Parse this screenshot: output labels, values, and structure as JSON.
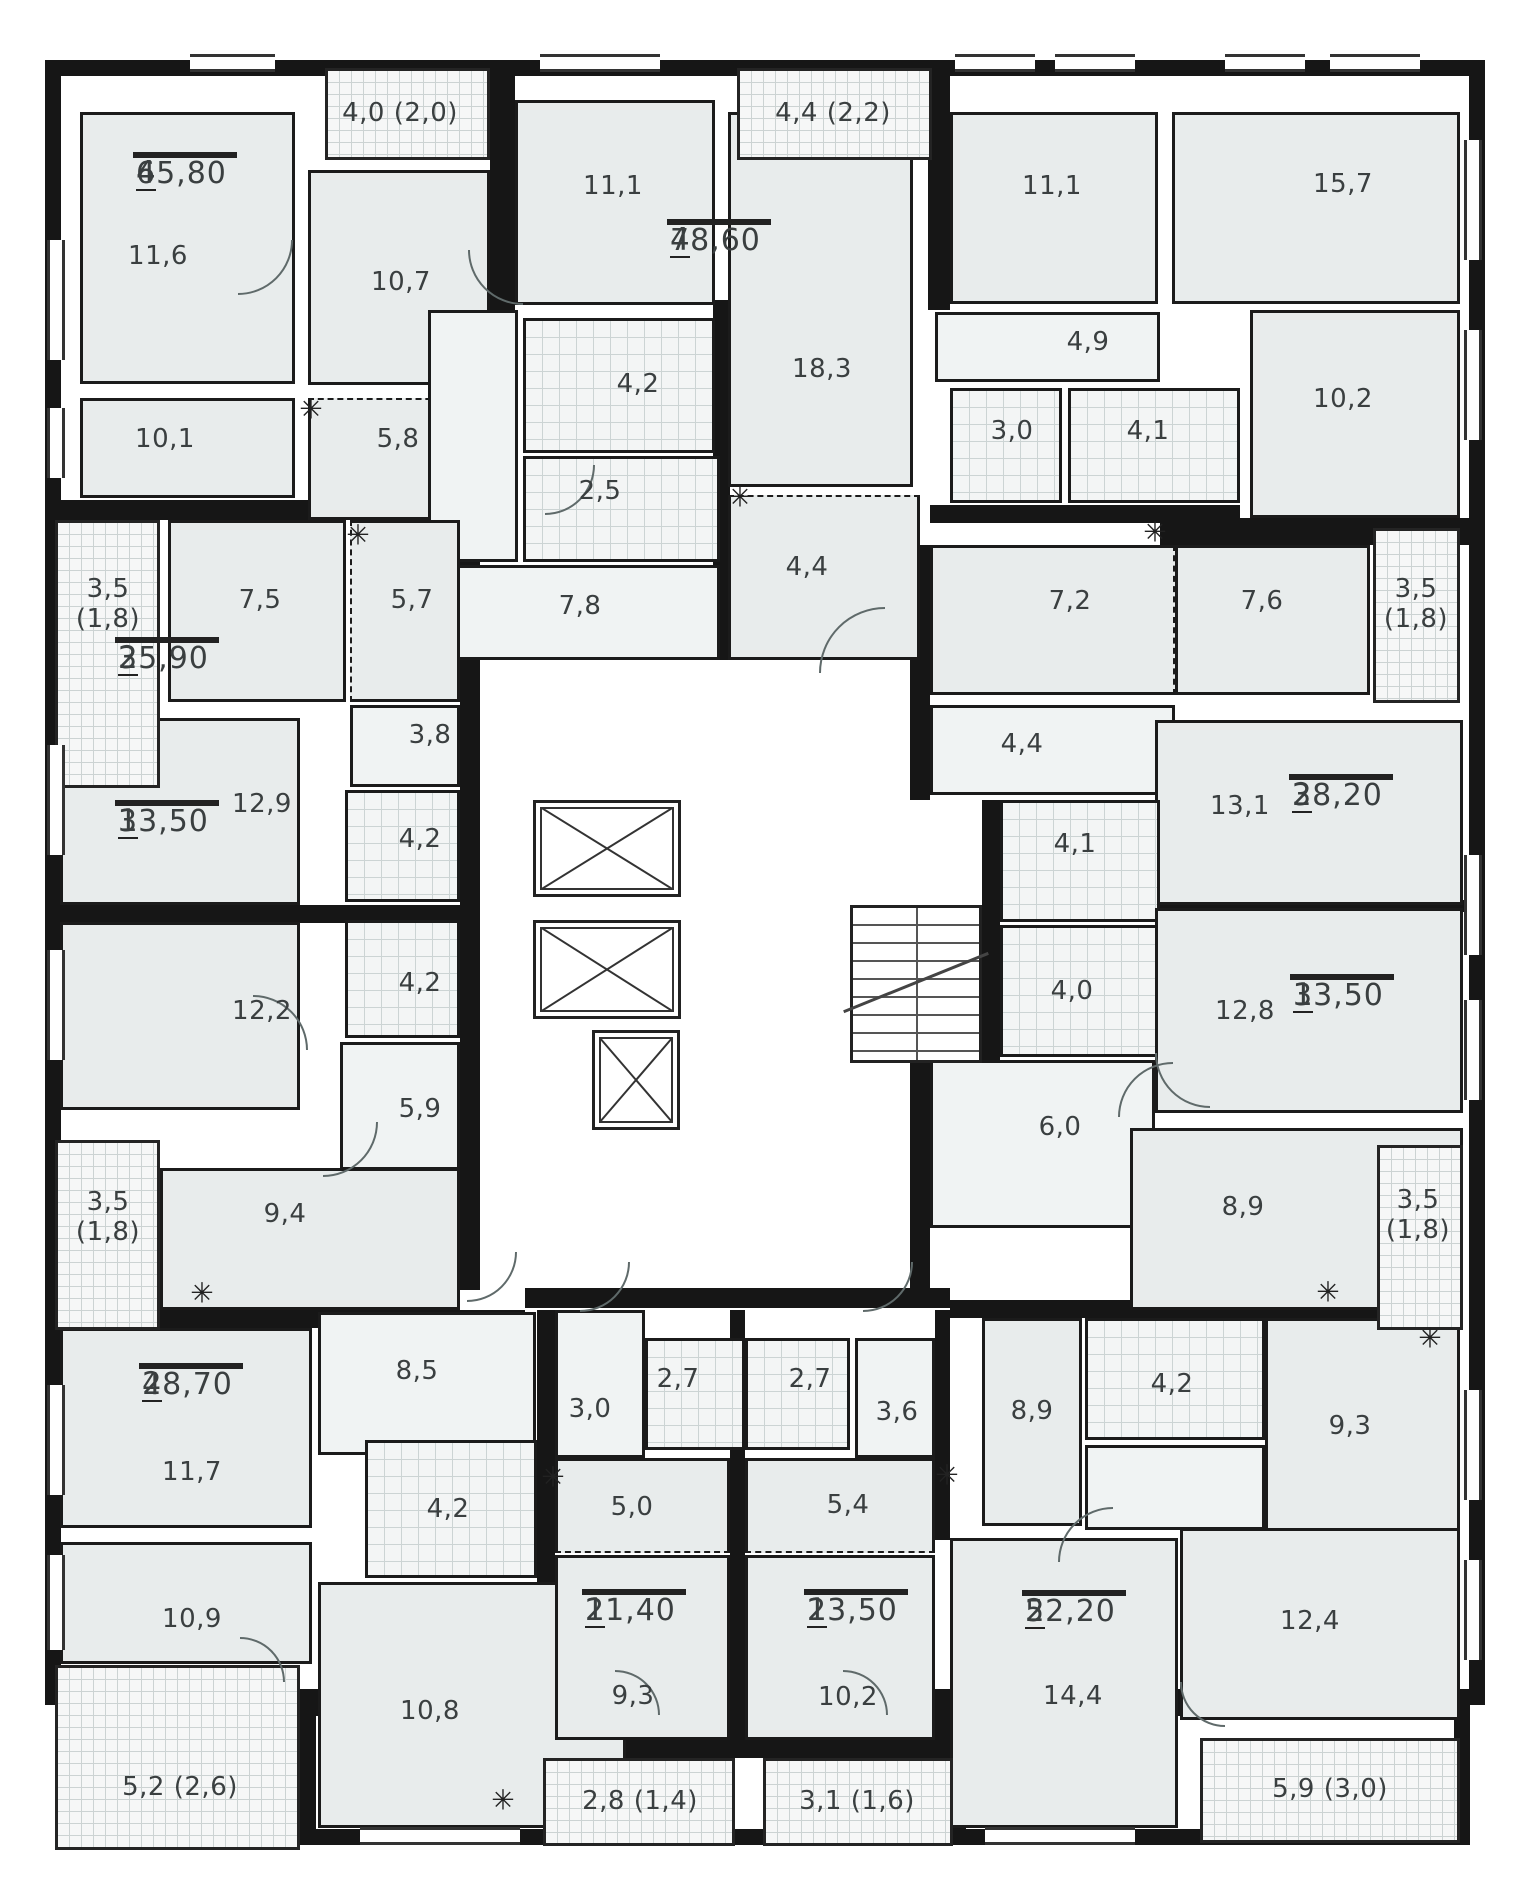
{
  "plan": {
    "canvas": {
      "w": 1529,
      "h": 1900
    },
    "colors": {
      "wall": "#161616",
      "room": "#e8ecec",
      "hall": "#f0f3f3",
      "wet_tile": "#f3f5f5",
      "balcony": "#f6f7f7",
      "text": "#3a3f40"
    },
    "envelope": [
      {
        "x": 45,
        "y": 60,
        "w": 1440,
        "h": 1645
      },
      {
        "x": 300,
        "y": 1700,
        "w": 650,
        "h": 145
      },
      {
        "x": 950,
        "y": 1700,
        "w": 520,
        "h": 145
      }
    ],
    "walls": [
      {
        "x": 490,
        "y": 60,
        "w": 25,
        "h": 460
      },
      {
        "x": 45,
        "y": 500,
        "w": 420,
        "h": 20
      },
      {
        "x": 460,
        "y": 520,
        "w": 20,
        "h": 770
      },
      {
        "x": 713,
        "y": 300,
        "w": 17,
        "h": 360
      },
      {
        "x": 928,
        "y": 60,
        "w": 22,
        "h": 250
      },
      {
        "x": 930,
        "y": 505,
        "w": 310,
        "h": 18
      },
      {
        "x": 1160,
        "y": 518,
        "w": 325,
        "h": 27
      },
      {
        "x": 910,
        "y": 545,
        "w": 20,
        "h": 255
      },
      {
        "x": 982,
        "y": 800,
        "w": 18,
        "h": 260
      },
      {
        "x": 910,
        "y": 1060,
        "w": 20,
        "h": 230
      },
      {
        "x": 1155,
        "y": 900,
        "w": 330,
        "h": 12
      },
      {
        "x": 45,
        "y": 905,
        "w": 420,
        "h": 18
      },
      {
        "x": 45,
        "y": 1310,
        "w": 480,
        "h": 18
      },
      {
        "x": 525,
        "y": 1288,
        "w": 425,
        "h": 20
      },
      {
        "x": 730,
        "y": 1310,
        "w": 15,
        "h": 430
      },
      {
        "x": 537,
        "y": 1310,
        "w": 18,
        "h": 430
      },
      {
        "x": 935,
        "y": 1310,
        "w": 15,
        "h": 230
      },
      {
        "x": 950,
        "y": 1300,
        "w": 513,
        "h": 18
      },
      {
        "x": 543,
        "y": 1740,
        "w": 392,
        "h": 18
      }
    ],
    "rooms": [
      {
        "x": 80,
        "y": 112,
        "w": 215,
        "h": 272,
        "f": "rm"
      },
      {
        "x": 80,
        "y": 398,
        "w": 215,
        "h": 100,
        "f": "rm"
      },
      {
        "x": 308,
        "y": 170,
        "w": 182,
        "h": 215,
        "f": "rm"
      },
      {
        "x": 308,
        "y": 398,
        "w": 182,
        "h": 122,
        "f": "rm",
        "d": "t"
      },
      {
        "x": 515,
        "y": 100,
        "w": 200,
        "h": 205,
        "f": "rm"
      },
      {
        "x": 523,
        "y": 318,
        "w": 192,
        "h": 135,
        "f": "wet"
      },
      {
        "x": 523,
        "y": 456,
        "w": 197,
        "h": 106,
        "f": "wet"
      },
      {
        "x": 428,
        "y": 310,
        "w": 90,
        "h": 252,
        "f": "hall"
      },
      {
        "x": 428,
        "y": 565,
        "w": 292,
        "h": 95,
        "f": "hall"
      },
      {
        "x": 728,
        "y": 112,
        "w": 185,
        "h": 375,
        "f": "rm"
      },
      {
        "x": 728,
        "y": 495,
        "w": 192,
        "h": 165,
        "f": "rm",
        "d": "t"
      },
      {
        "x": 950,
        "y": 112,
        "w": 208,
        "h": 192,
        "f": "rm"
      },
      {
        "x": 1172,
        "y": 112,
        "w": 288,
        "h": 192,
        "f": "rm"
      },
      {
        "x": 935,
        "y": 312,
        "w": 225,
        "h": 70,
        "f": "hall"
      },
      {
        "x": 950,
        "y": 388,
        "w": 112,
        "h": 115,
        "f": "wet"
      },
      {
        "x": 1068,
        "y": 388,
        "w": 172,
        "h": 115,
        "f": "wet"
      },
      {
        "x": 1250,
        "y": 310,
        "w": 210,
        "h": 208,
        "f": "rm"
      },
      {
        "x": 930,
        "y": 545,
        "w": 245,
        "h": 150,
        "f": "rm",
        "d": "r"
      },
      {
        "x": 1175,
        "y": 545,
        "w": 195,
        "h": 150,
        "f": "rm"
      },
      {
        "x": 930,
        "y": 705,
        "w": 245,
        "h": 90,
        "f": "hall"
      },
      {
        "x": 1155,
        "y": 720,
        "w": 308,
        "h": 185,
        "f": "rm"
      },
      {
        "x": 1000,
        "y": 800,
        "w": 160,
        "h": 122,
        "f": "wet"
      },
      {
        "x": 1000,
        "y": 925,
        "w": 160,
        "h": 132,
        "f": "wet"
      },
      {
        "x": 1155,
        "y": 908,
        "w": 308,
        "h": 205,
        "f": "rm"
      },
      {
        "x": 930,
        "y": 1060,
        "w": 225,
        "h": 168,
        "f": "hall"
      },
      {
        "x": 1130,
        "y": 1128,
        "w": 333,
        "h": 182,
        "f": "rm"
      },
      {
        "x": 982,
        "y": 1318,
        "w": 100,
        "h": 208,
        "f": "rm"
      },
      {
        "x": 1085,
        "y": 1318,
        "w": 180,
        "h": 122,
        "f": "wet"
      },
      {
        "x": 1085,
        "y": 1445,
        "w": 180,
        "h": 85,
        "f": "hall"
      },
      {
        "x": 1265,
        "y": 1318,
        "w": 195,
        "h": 215,
        "f": "rm"
      },
      {
        "x": 950,
        "y": 1538,
        "w": 228,
        "h": 290,
        "f": "rm"
      },
      {
        "x": 1180,
        "y": 1528,
        "w": 280,
        "h": 192,
        "f": "rm"
      },
      {
        "x": 168,
        "y": 520,
        "w": 178,
        "h": 182,
        "f": "rm"
      },
      {
        "x": 350,
        "y": 520,
        "w": 110,
        "h": 182,
        "f": "rm",
        "d": "l"
      },
      {
        "x": 60,
        "y": 718,
        "w": 240,
        "h": 187,
        "f": "rm"
      },
      {
        "x": 350,
        "y": 705,
        "w": 110,
        "h": 82,
        "f": "hall"
      },
      {
        "x": 345,
        "y": 790,
        "w": 115,
        "h": 112,
        "f": "wet"
      },
      {
        "x": 60,
        "y": 922,
        "w": 240,
        "h": 188,
        "f": "rm"
      },
      {
        "x": 345,
        "y": 920,
        "w": 115,
        "h": 118,
        "f": "wet"
      },
      {
        "x": 340,
        "y": 1042,
        "w": 120,
        "h": 128,
        "f": "hall"
      },
      {
        "x": 160,
        "y": 1168,
        "w": 300,
        "h": 142,
        "f": "rm"
      },
      {
        "x": 60,
        "y": 1328,
        "w": 252,
        "h": 200,
        "f": "rm"
      },
      {
        "x": 60,
        "y": 1542,
        "w": 252,
        "h": 122,
        "f": "rm"
      },
      {
        "x": 318,
        "y": 1312,
        "w": 218,
        "h": 143,
        "f": "hall"
      },
      {
        "x": 365,
        "y": 1440,
        "w": 172,
        "h": 138,
        "f": "wet"
      },
      {
        "x": 318,
        "y": 1582,
        "w": 308,
        "h": 246,
        "f": "rm"
      },
      {
        "x": 555,
        "y": 1310,
        "w": 90,
        "h": 148,
        "f": "hall"
      },
      {
        "x": 645,
        "y": 1338,
        "w": 100,
        "h": 112,
        "f": "wet"
      },
      {
        "x": 555,
        "y": 1458,
        "w": 175,
        "h": 95,
        "f": "rm",
        "d": "b"
      },
      {
        "x": 555,
        "y": 1555,
        "w": 175,
        "h": 185,
        "f": "rm"
      },
      {
        "x": 745,
        "y": 1338,
        "w": 105,
        "h": 112,
        "f": "wet"
      },
      {
        "x": 855,
        "y": 1338,
        "w": 80,
        "h": 120,
        "f": "hall"
      },
      {
        "x": 745,
        "y": 1458,
        "w": 190,
        "h": 95,
        "f": "rm",
        "d": "b"
      },
      {
        "x": 745,
        "y": 1555,
        "w": 190,
        "h": 185,
        "f": "rm"
      }
    ],
    "room_labels": [
      {
        "text": "11,6",
        "x": 158,
        "y": 257
      },
      {
        "text": "10,1",
        "x": 165,
        "y": 440
      },
      {
        "text": "10,7",
        "x": 401,
        "y": 283
      },
      {
        "text": "5,8",
        "x": 398,
        "y": 440
      },
      {
        "text": "11,1",
        "x": 613,
        "y": 187
      },
      {
        "text": "4,2",
        "x": 638,
        "y": 385
      },
      {
        "text": "2,5",
        "x": 600,
        "y": 492
      },
      {
        "text": "7,8",
        "x": 580,
        "y": 607
      },
      {
        "text": "18,3",
        "x": 822,
        "y": 370
      },
      {
        "text": "4,4",
        "x": 807,
        "y": 568
      },
      {
        "text": "11,1",
        "x": 1052,
        "y": 187
      },
      {
        "text": "15,7",
        "x": 1343,
        "y": 185
      },
      {
        "text": "4,9",
        "x": 1088,
        "y": 343
      },
      {
        "text": "3,0",
        "x": 1012,
        "y": 432
      },
      {
        "text": "4,1",
        "x": 1148,
        "y": 432
      },
      {
        "text": "10,2",
        "x": 1343,
        "y": 400
      },
      {
        "text": "7,5",
        "x": 260,
        "y": 601
      },
      {
        "text": "5,7",
        "x": 412,
        "y": 601
      },
      {
        "text": "3,8",
        "x": 430,
        "y": 736
      },
      {
        "text": "12,9",
        "x": 262,
        "y": 805
      },
      {
        "text": "4,2",
        "x": 420,
        "y": 840
      },
      {
        "text": "7,2",
        "x": 1070,
        "y": 602
      },
      {
        "text": "7,6",
        "x": 1262,
        "y": 602
      },
      {
        "text": "4,4",
        "x": 1022,
        "y": 745
      },
      {
        "text": "13,1",
        "x": 1240,
        "y": 807
      },
      {
        "text": "4,1",
        "x": 1075,
        "y": 845
      },
      {
        "text": "4,0",
        "x": 1072,
        "y": 992
      },
      {
        "text": "12,8",
        "x": 1245,
        "y": 1012
      },
      {
        "text": "6,0",
        "x": 1060,
        "y": 1128
      },
      {
        "text": "12,2",
        "x": 262,
        "y": 1012
      },
      {
        "text": "4,2",
        "x": 420,
        "y": 984
      },
      {
        "text": "5,9",
        "x": 420,
        "y": 1110
      },
      {
        "text": "9,4",
        "x": 285,
        "y": 1215
      },
      {
        "text": "8,9",
        "x": 1243,
        "y": 1208
      },
      {
        "text": "11,7",
        "x": 192,
        "y": 1473
      },
      {
        "text": "8,5",
        "x": 417,
        "y": 1372
      },
      {
        "text": "4,2",
        "x": 448,
        "y": 1510
      },
      {
        "text": "10,9",
        "x": 192,
        "y": 1620
      },
      {
        "text": "10,8",
        "x": 430,
        "y": 1712
      },
      {
        "text": "3,0",
        "x": 590,
        "y": 1410
      },
      {
        "text": "2,7",
        "x": 678,
        "y": 1380
      },
      {
        "text": "2,7",
        "x": 810,
        "y": 1380
      },
      {
        "text": "3,6",
        "x": 897,
        "y": 1413
      },
      {
        "text": "5,0",
        "x": 632,
        "y": 1508
      },
      {
        "text": "5,4",
        "x": 848,
        "y": 1506
      },
      {
        "text": "9,3",
        "x": 633,
        "y": 1697
      },
      {
        "text": "10,2",
        "x": 848,
        "y": 1698
      },
      {
        "text": "8,9",
        "x": 1032,
        "y": 1412
      },
      {
        "text": "4,2",
        "x": 1172,
        "y": 1385
      },
      {
        "text": "9,3",
        "x": 1350,
        "y": 1427
      },
      {
        "text": "14,4",
        "x": 1073,
        "y": 1697
      },
      {
        "text": "12,4",
        "x": 1310,
        "y": 1622
      }
    ],
    "apartments": [
      {
        "rooms": "4",
        "area": "65,80",
        "x": 133,
        "y": 152
      },
      {
        "rooms": "4",
        "area": "78,60",
        "x": 667,
        "y": 219
      },
      {
        "rooms": "2",
        "area": "35,90",
        "x": 115,
        "y": 637
      },
      {
        "rooms": "2",
        "area": "38,20",
        "x": 1289,
        "y": 774
      },
      {
        "rooms": "1",
        "area": "33,50",
        "x": 115,
        "y": 800
      },
      {
        "rooms": "1",
        "area": "33,50",
        "x": 1290,
        "y": 974
      },
      {
        "rooms": "2",
        "area": "48,70",
        "x": 139,
        "y": 1363
      },
      {
        "rooms": "1",
        "area": "21,40",
        "x": 582,
        "y": 1589
      },
      {
        "rooms": "1",
        "area": "23,50",
        "x": 804,
        "y": 1589
      },
      {
        "rooms": "2",
        "area": "52,20",
        "x": 1022,
        "y": 1590
      }
    ],
    "balconies": [
      {
        "text": "4,0 (2,0)",
        "x": 325,
        "y": 68,
        "w": 165,
        "h": 92,
        "tx": 400,
        "ty": 114
      },
      {
        "text": "4,4 (2,2)",
        "x": 737,
        "y": 68,
        "w": 195,
        "h": 92,
        "tx": 833,
        "ty": 114
      },
      {
        "text": "3,5\n(1,8)",
        "x": 55,
        "y": 520,
        "w": 105,
        "h": 268,
        "tx": 108,
        "ty": 605
      },
      {
        "text": "3,5\n(1,8)",
        "x": 1373,
        "y": 528,
        "w": 87,
        "h": 175,
        "tx": 1416,
        "ty": 605
      },
      {
        "text": "3,5\n(1,8)",
        "x": 55,
        "y": 1140,
        "w": 105,
        "h": 190,
        "tx": 108,
        "ty": 1218
      },
      {
        "text": "3,5\n(1,8)",
        "x": 1377,
        "y": 1145,
        "w": 86,
        "h": 185,
        "tx": 1418,
        "ty": 1216
      },
      {
        "text": "5,2 (2,6)",
        "x": 55,
        "y": 1665,
        "w": 245,
        "h": 185,
        "tx": 180,
        "ty": 1788
      },
      {
        "text": "2,8 (1,4)",
        "x": 543,
        "y": 1758,
        "w": 192,
        "h": 88,
        "tx": 640,
        "ty": 1802
      },
      {
        "text": "3,1 (1,6)",
        "x": 763,
        "y": 1758,
        "w": 190,
        "h": 88,
        "tx": 857,
        "ty": 1802
      },
      {
        "text": "5,9 (3,0)",
        "x": 1200,
        "y": 1738,
        "w": 260,
        "h": 105,
        "tx": 1330,
        "ty": 1790
      }
    ],
    "elevators": [
      {
        "x": 533,
        "y": 800,
        "w": 148,
        "h": 97
      },
      {
        "x": 533,
        "y": 920,
        "w": 148,
        "h": 99
      },
      {
        "x": 592,
        "y": 1030,
        "w": 88,
        "h": 100
      }
    ],
    "stairs": {
      "x": 850,
      "y": 905,
      "w": 132,
      "h": 158
    },
    "windows": [
      {
        "x": 190,
        "y": 54,
        "w": 85,
        "h": 18
      },
      {
        "x": 540,
        "y": 54,
        "w": 120,
        "h": 18
      },
      {
        "x": 955,
        "y": 54,
        "w": 80,
        "h": 18
      },
      {
        "x": 1055,
        "y": 54,
        "w": 80,
        "h": 18
      },
      {
        "x": 1225,
        "y": 54,
        "w": 80,
        "h": 18
      },
      {
        "x": 1330,
        "y": 54,
        "w": 90,
        "h": 18
      },
      {
        "x": 47,
        "y": 240,
        "w": 18,
        "h": 120
      },
      {
        "x": 47,
        "y": 408,
        "w": 18,
        "h": 70
      },
      {
        "x": 47,
        "y": 745,
        "w": 18,
        "h": 110
      },
      {
        "x": 47,
        "y": 950,
        "w": 18,
        "h": 110
      },
      {
        "x": 47,
        "y": 1385,
        "w": 18,
        "h": 110
      },
      {
        "x": 47,
        "y": 1555,
        "w": 18,
        "h": 95
      },
      {
        "x": 1464,
        "y": 140,
        "w": 18,
        "h": 120
      },
      {
        "x": 1464,
        "y": 330,
        "w": 18,
        "h": 110
      },
      {
        "x": 1464,
        "y": 855,
        "w": 18,
        "h": 100
      },
      {
        "x": 1464,
        "y": 1000,
        "w": 18,
        "h": 100
      },
      {
        "x": 1464,
        "y": 1390,
        "w": 18,
        "h": 110
      },
      {
        "x": 1464,
        "y": 1560,
        "w": 18,
        "h": 100
      },
      {
        "x": 360,
        "y": 1827,
        "w": 160,
        "h": 18
      },
      {
        "x": 985,
        "y": 1827,
        "w": 150,
        "h": 18
      }
    ],
    "appliance_icons": [
      {
        "x": 311,
        "y": 409
      },
      {
        "x": 358,
        "y": 535
      },
      {
        "x": 740,
        "y": 497
      },
      {
        "x": 1155,
        "y": 532
      },
      {
        "x": 202,
        "y": 1293
      },
      {
        "x": 553,
        "y": 1477
      },
      {
        "x": 947,
        "y": 1475
      },
      {
        "x": 1328,
        "y": 1292
      },
      {
        "x": 1430,
        "y": 1338
      },
      {
        "x": 503,
        "y": 1800
      }
    ],
    "door_arcs": [
      {
        "x": 238,
        "y": 240,
        "r": 55,
        "rot": 1
      },
      {
        "x": 523,
        "y": 250,
        "r": 55,
        "rot": 2
      },
      {
        "x": 545,
        "y": 465,
        "r": 50,
        "rot": 1
      },
      {
        "x": 885,
        "y": 673,
        "r": 66,
        "rot": 3
      },
      {
        "x": 253,
        "y": 1050,
        "r": 55,
        "rot": 0
      },
      {
        "x": 323,
        "y": 1122,
        "r": 55,
        "rot": 1
      },
      {
        "x": 1210,
        "y": 1053,
        "r": 55,
        "rot": 2
      },
      {
        "x": 1173,
        "y": 1117,
        "r": 55,
        "rot": 3
      },
      {
        "x": 580,
        "y": 1262,
        "r": 50,
        "rot": 1
      },
      {
        "x": 863,
        "y": 1262,
        "r": 50,
        "rot": 1
      },
      {
        "x": 615,
        "y": 1715,
        "r": 45,
        "rot": 0
      },
      {
        "x": 843,
        "y": 1715,
        "r": 45,
        "rot": 0
      },
      {
        "x": 1225,
        "y": 1682,
        "r": 45,
        "rot": 2
      },
      {
        "x": 1113,
        "y": 1562,
        "r": 55,
        "rot": 3
      },
      {
        "x": 240,
        "y": 1682,
        "r": 45,
        "rot": 0
      },
      {
        "x": 467,
        "y": 1252,
        "r": 50,
        "rot": 1
      }
    ]
  }
}
